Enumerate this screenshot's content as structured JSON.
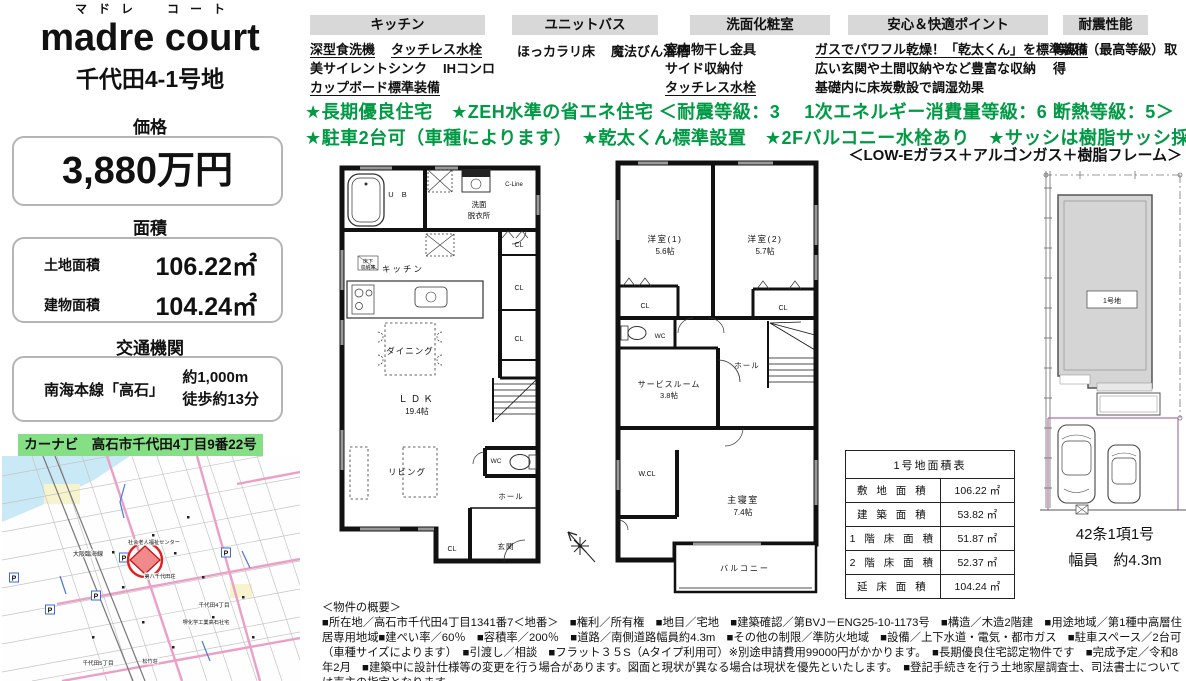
{
  "header": {
    "furigana": "マドレ　コート",
    "logo": "madre court",
    "lot": "千代田4-1号地"
  },
  "price": {
    "heading": "価格",
    "value": "3,880万円"
  },
  "area": {
    "heading": "面積",
    "rows": [
      {
        "name": "土地面積",
        "value": "106.22㎡"
      },
      {
        "name": "建物面積",
        "value": "104.24㎡"
      }
    ]
  },
  "transport": {
    "heading": "交通機関",
    "line": "南海本線「高石」",
    "distance": "約1,000m",
    "walk": "徒歩約13分"
  },
  "carnavi": "カーナビ　高石市千代田4丁目9番22号付近",
  "features": {
    "kitchen": {
      "title": "キッチン",
      "items": [
        "深型食洗機",
        "タッチレス水栓",
        "美サイレントシンク",
        "IHコンロ",
        "カップボード標準装備"
      ]
    },
    "bath": {
      "title": "ユニットバス",
      "items": [
        "ほっカラリ床",
        "魔法びん浴槽"
      ]
    },
    "powder": {
      "title": "洗面化粧室",
      "items": [
        "室内物干し金具",
        "サイド収納付",
        "タッチレス水栓"
      ]
    },
    "comfort": {
      "title": "安心＆快適ポイント",
      "items": [
        "ガスでパワフル乾燥！「乾太くん」を標準装備",
        "広い玄関や土間収納やなど豊富な収納",
        "基礎内に床炭敷設で調湿効果"
      ]
    },
    "quake": {
      "title": "耐震性能",
      "items": [
        "等級3（最高等級）取得"
      ]
    }
  },
  "highlights": {
    "line1": "★長期優良住宅　★ZEH水準の省エネ住宅 ＜耐震等級：3　 1次エネルギー消費量等級：6  断熱等級：5＞",
    "line2": "★駐車2台可（車種によります）　★乾太くん標準設置　★2Fバルコニー水栓あり　★サッシは樹脂サッシ採用",
    "line3": "＜LOW-Eガラス＋アルゴンガス＋樹脂フレーム＞"
  },
  "plan1": {
    "ub": "U B",
    "washroom1": "洗面",
    "washroom2": "脱衣所",
    "cline": "C-Line",
    "kitchen": "キッチン",
    "underfloor1": "床下",
    "underfloor2": "収納庫",
    "cl": "CL",
    "ldk1": "ＬＤＫ",
    "ldk2": "19.4帖",
    "dining": "ダイニング",
    "living": "リビング",
    "wc": "WC",
    "hall": "ホール",
    "genkan": "玄関"
  },
  "plan2": {
    "room1a": "洋室(1)",
    "room1b": "5.6帖",
    "room2a": "洋室(2)",
    "room2b": "5.7帖",
    "cl": "CL",
    "wc": "WC",
    "hall": "ホール",
    "service1": "サービスルーム",
    "service2": "3.8帖",
    "wcl": "W.CL",
    "master1": "主寝室",
    "master2": "7.4帖",
    "balcony": "バルコニー"
  },
  "siteplan": {
    "lot": "1号地",
    "road1": "42条1項1号",
    "road2": "幅員　約4.3m"
  },
  "table": {
    "title": "1号地面積表",
    "rows": [
      {
        "name": "敷 地 面 積",
        "value": "106.22 ㎡"
      },
      {
        "name": "建 築 面 積",
        "value": "53.82 ㎡"
      },
      {
        "name": "1 階 床 面 積",
        "value": "51.87 ㎡"
      },
      {
        "name": "2 階 床 面 積",
        "value": "52.37 ㎡"
      },
      {
        "name": "延 床 面 積",
        "value": "104.24 ㎡"
      }
    ]
  },
  "overview": {
    "title": "＜物件の概要＞",
    "body": "■所在地／高石市千代田4丁目1341番7＜地番＞　■権利／所有権　■地目／宅地　■建築確認／第BVJ－ENG25-10-1173号　■構造／木造2階建　■用途地域／第1種中高層住居専用地域■建ぺい率／60％　■容積率／200％　■道路／南側道路幅員約4.3m　■その他の制限／準防火地域　■設備／上下水道・電気・都市ガス　■駐車スペース／2台可（車種サイズによります）　■引渡し／相談　■フラット３５S（Aタイプ利用可）※別途申請費用99000円がかかります。　■長期優良住宅認定物件です　■完成予定／令和8年2月　■建築中に設計仕様等の変更を行う場合があります。図面と現状が異なる場合は現状を優先といたします。　■登記手続きを行う土地家屋調査士、司法書士については売主の指定となります。"
  },
  "map": {
    "p": "P",
    "l1": "大阪臨海線",
    "l2": "社会老人福祉センター",
    "l3": "第八千代田荘",
    "l4": "堺化学工業高石社宅",
    "l5": "松竹荘",
    "l6": "千代田4丁目",
    "l7": "千代田5丁目"
  },
  "colors": {
    "green": "#009944",
    "bar_green": "#85df85",
    "header_gray": "#d8d8d8"
  }
}
